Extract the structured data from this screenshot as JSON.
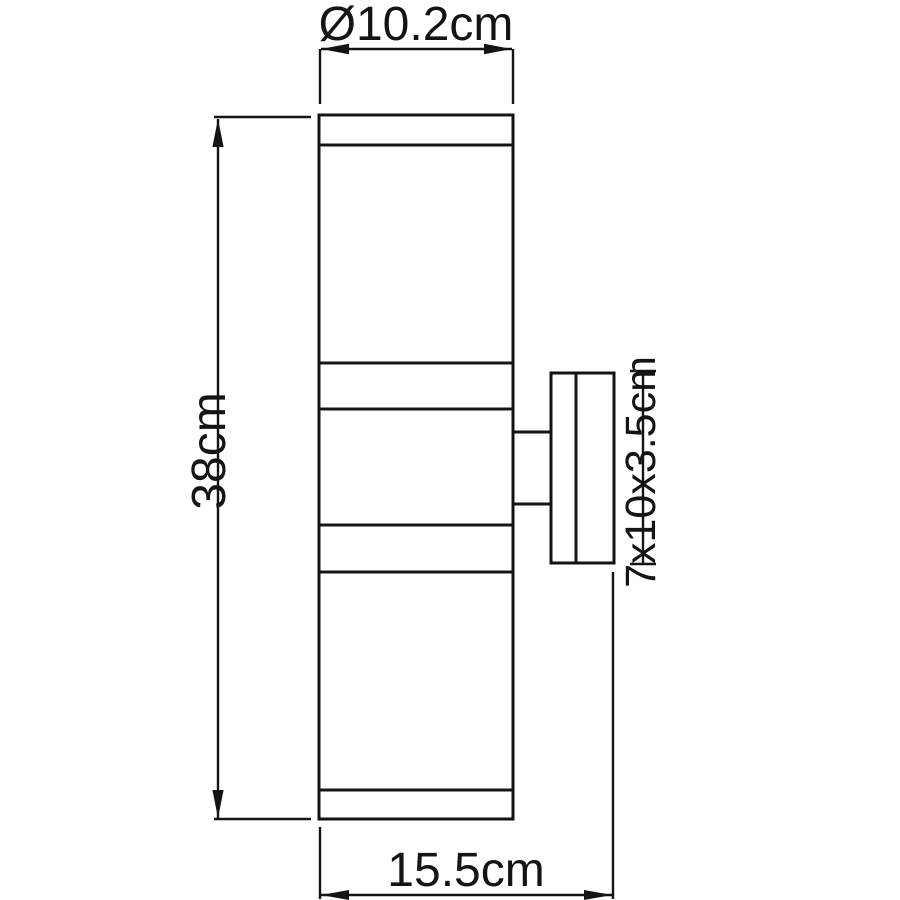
{
  "page": {
    "background": "#ffffff",
    "line_color": "#141414"
  },
  "diagram": {
    "labels": {
      "diameter": "Ø10.2cm",
      "height": "38cm",
      "bracket_size": "7x10x3.5cm",
      "width": "15.5cm"
    }
  }
}
